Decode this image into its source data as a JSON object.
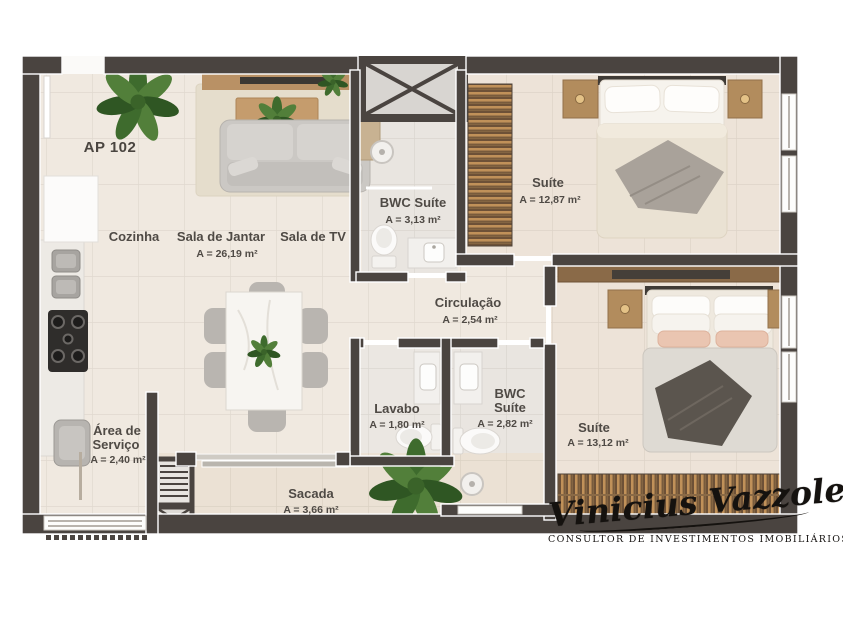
{
  "plan": {
    "unit_label": "AP 102",
    "rooms": {
      "cozinha": {
        "name": "Cozinha"
      },
      "sala_de_jantar": {
        "name": "Sala de Jantar",
        "area": "A = 26,19 m²"
      },
      "sala_de_tv": {
        "name": "Sala de TV"
      },
      "bwc_suite_1": {
        "name": "BWC Suíte",
        "area": "A = 3,13 m²"
      },
      "suite_1": {
        "name": "Suíte",
        "area": "A = 12,87 m²"
      },
      "circulacao": {
        "name": "Circulação",
        "area": "A = 2,54 m²"
      },
      "lavabo": {
        "name": "Lavabo",
        "area": "A = 1,80 m²"
      },
      "bwc_suite_2": {
        "name_line1": "BWC",
        "name_line2": "Suíte",
        "area": "A = 2,82 m²"
      },
      "suite_2": {
        "name": "Suíte",
        "area": "A = 13,12 m²"
      },
      "area_de_servico": {
        "name_line1": "Área de",
        "name_line2": "Serviço",
        "area": "A = 2,40 m²"
      },
      "sacada": {
        "name": "Sacada",
        "area": "A = 3,66 m²"
      }
    }
  },
  "branding": {
    "signature": "Vinicius Vazzoletti",
    "tagline": "CONSULTOR DE INVESTIMENTOS IMOBILIÁRIOS"
  },
  "colors": {
    "wall": "#4a4440",
    "floor": "#f0e9e0",
    "floor_suite": "#ede3d8",
    "floor_bath": "#e9e5e0",
    "floor_sacada": "#ebe1d4",
    "wood": "#b3905f",
    "wood_dark": "#6d5137",
    "furniture_gray": "#cbc8c4",
    "label_text": "#4f4a45",
    "signature_ink": "#15120f"
  }
}
